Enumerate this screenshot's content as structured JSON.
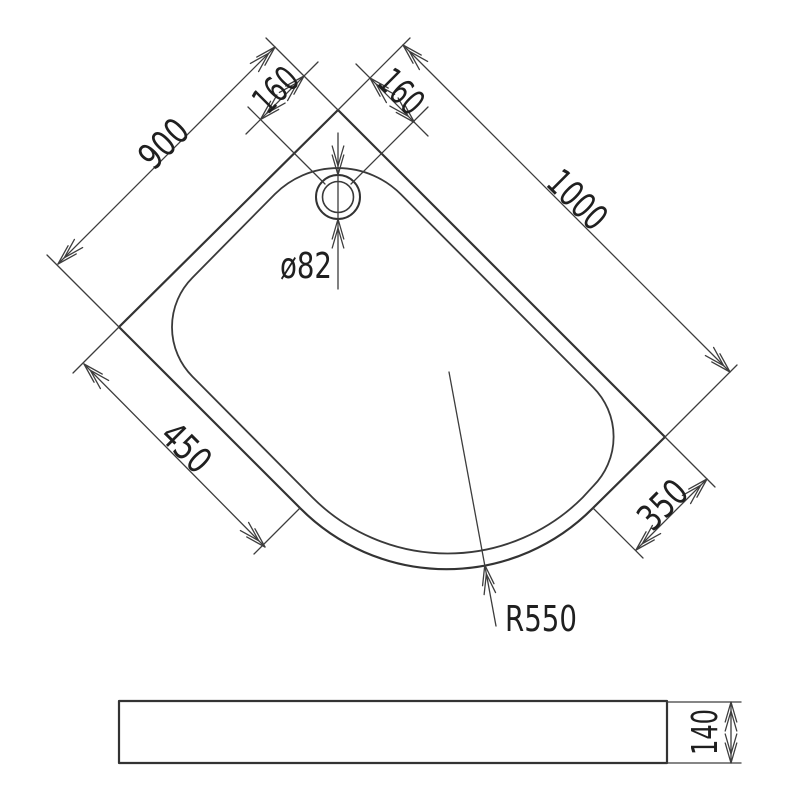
{
  "drawing": {
    "type": "quadrant-shower-tray-technical-drawing",
    "colors": {
      "background": "#ffffff",
      "outline": "#333333",
      "dimension_lines": "#3d3d3d",
      "text": "#1f1f1f"
    },
    "plan_view": {
      "dim_left_edge": "900",
      "dim_right_edge": "1000",
      "dim_drain_offset_left": "160",
      "dim_drain_offset_right": "160",
      "dim_front_left": "450",
      "dim_front_right": "350",
      "dim_drain_diameter": "ø82",
      "dim_front_radius": "R550"
    },
    "side_view": {
      "dim_height": "140"
    }
  }
}
